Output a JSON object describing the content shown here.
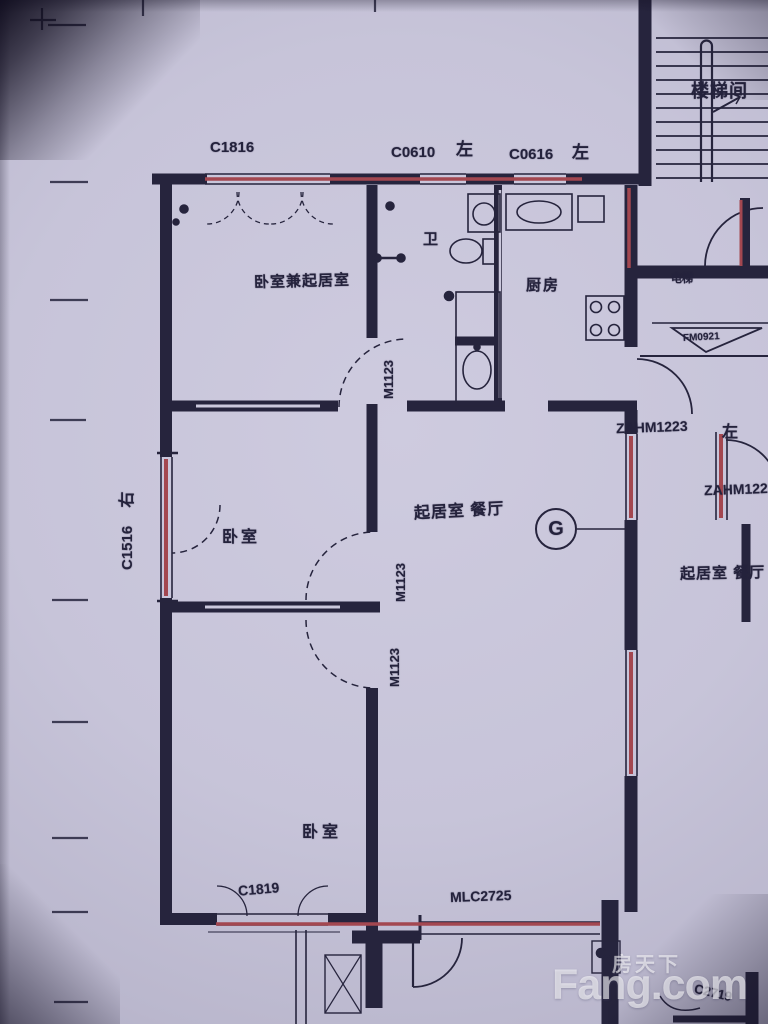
{
  "colors": {
    "paper_tint": "#c7c4d9",
    "ink": "#26243d",
    "red_marker": "#a34750",
    "watermark": "rgba(255,255,255,0.58)"
  },
  "plan": {
    "window_labels": {
      "c1816": "C1816",
      "c0610": "C0610",
      "c0616": "C0616",
      "c1516": "C1516",
      "c1819": "C1819",
      "c2719": "C2719"
    },
    "door_labels": {
      "m1123": "M1123",
      "zahm1223": "ZAHM1223",
      "mlc2725": "MLC2725",
      "fm0921": "FM0921"
    },
    "room_labels": {
      "stairwell": "楼梯间",
      "bedroom_living": "卧室兼起居室",
      "bath": "卫",
      "kitchen": "厨房",
      "bedroom": "卧室",
      "living_dining": "起居室 餐厅",
      "elevator": "电梯"
    },
    "direction_labels": {
      "left": "左",
      "right": "右"
    },
    "axis": {
      "g": "G"
    }
  },
  "watermark": {
    "cn": "房天下",
    "en": "Fang.com"
  }
}
